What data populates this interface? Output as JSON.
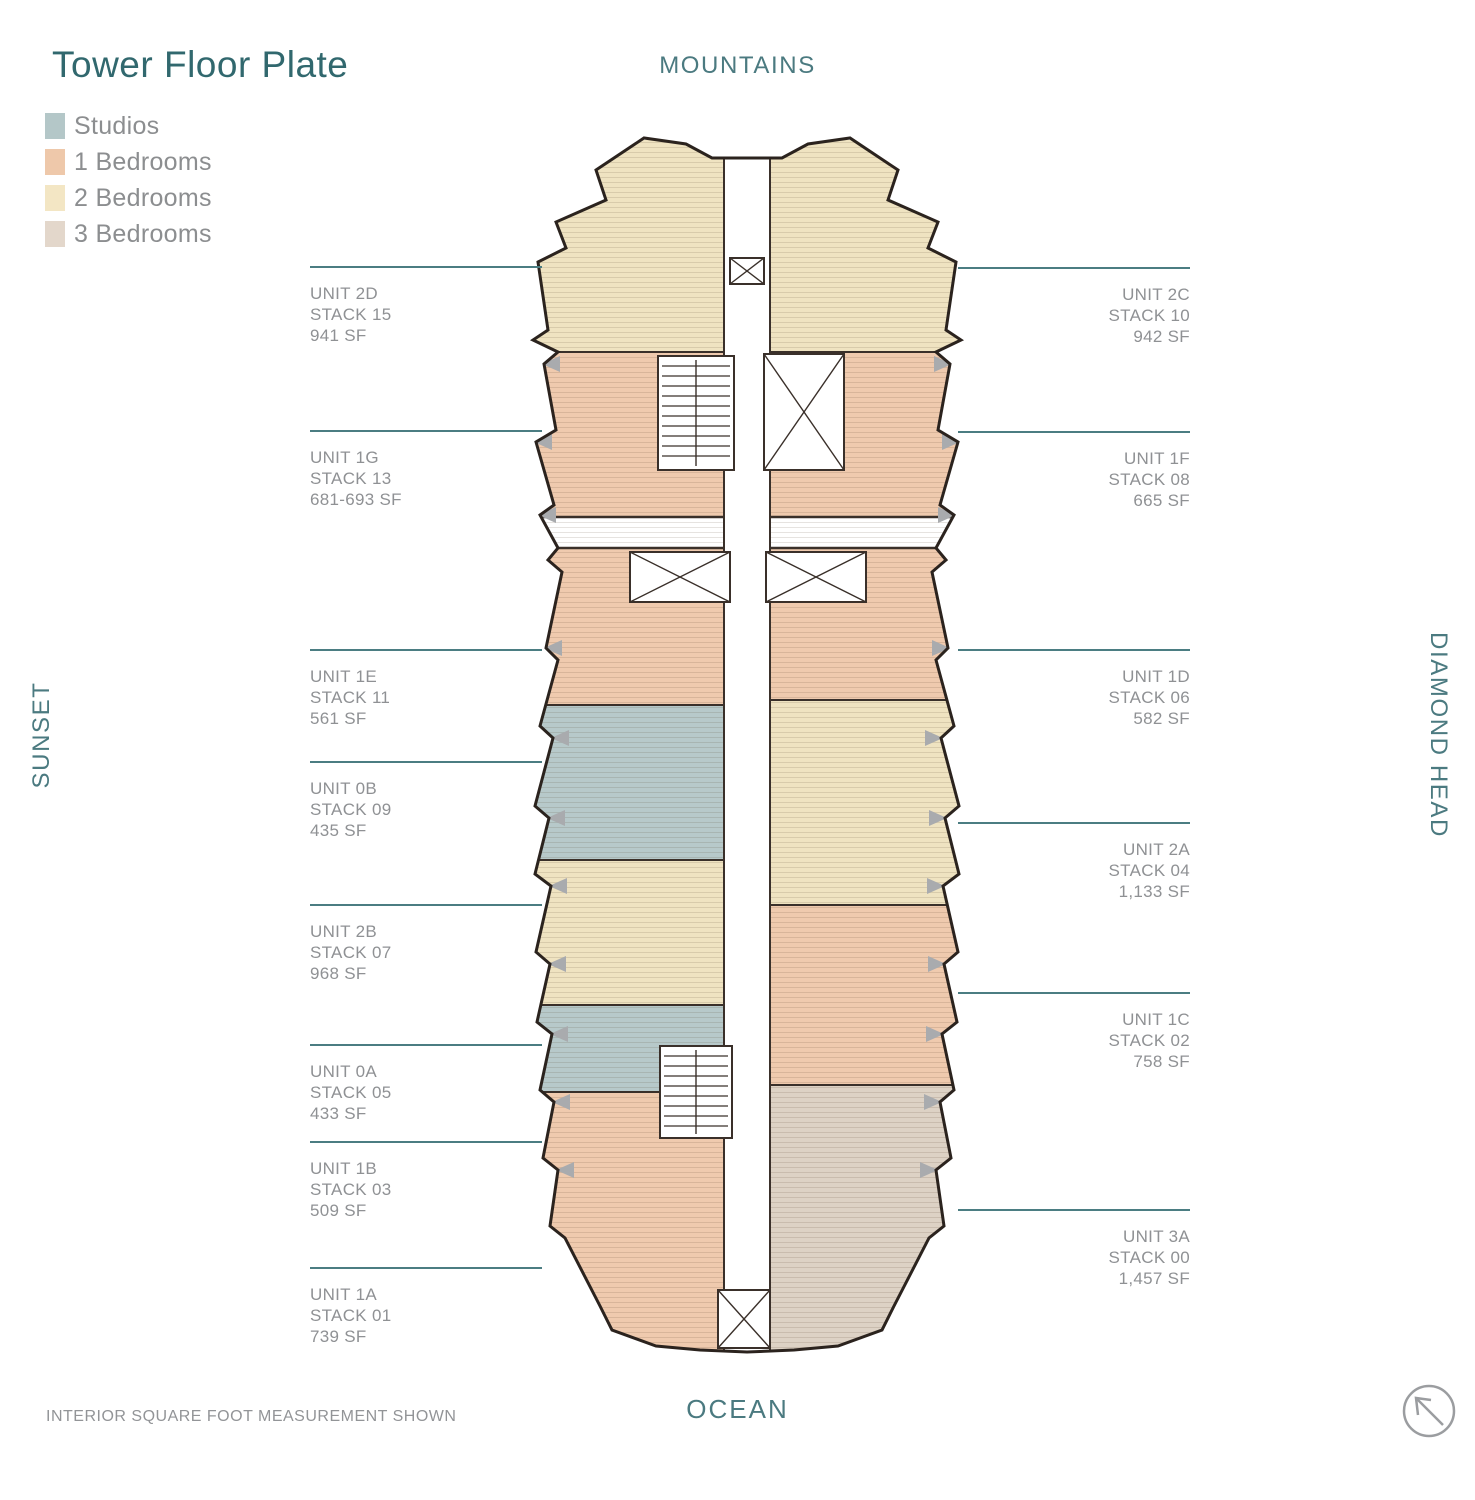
{
  "title": "Tower Floor Plate",
  "legend": {
    "items": [
      {
        "label": "Studios",
        "color": "#b4c7c8"
      },
      {
        "label": "1 Bedrooms",
        "color": "#eec8aa"
      },
      {
        "label": "2 Bedrooms",
        "color": "#f3e6c4"
      },
      {
        "label": "3 Bedrooms",
        "color": "#e3d7cb"
      }
    ]
  },
  "orientation": {
    "top": "MOUNTAINS",
    "bottom": "OCEAN",
    "left": "SUNSET",
    "right": "DIAMOND HEAD"
  },
  "units_left": [
    {
      "unit": "UNIT 2D",
      "stack": "STACK 15",
      "sf": "941 SF"
    },
    {
      "unit": "UNIT 1G",
      "stack": "STACK 13",
      "sf": "681-693 SF"
    },
    {
      "unit": "UNIT 1E",
      "stack": "STACK 11",
      "sf": "561 SF"
    },
    {
      "unit": "UNIT 0B",
      "stack": "STACK 09",
      "sf": "435 SF"
    },
    {
      "unit": "UNIT 2B",
      "stack": "STACK 07",
      "sf": "968 SF"
    },
    {
      "unit": "UNIT 0A",
      "stack": "STACK 05",
      "sf": "433 SF"
    },
    {
      "unit": "UNIT 1B",
      "stack": "STACK 03",
      "sf": "509 SF"
    },
    {
      "unit": "UNIT 1A",
      "stack": "STACK 01",
      "sf": "739 SF"
    }
  ],
  "units_right": [
    {
      "unit": "UNIT 2C",
      "stack": "STACK 10",
      "sf": "942 SF"
    },
    {
      "unit": "UNIT 1F",
      "stack": "STACK 08",
      "sf": "665 SF"
    },
    {
      "unit": "UNIT 1D",
      "stack": "STACK 06",
      "sf": "582 SF"
    },
    {
      "unit": "UNIT 2A",
      "stack": "STACK 04",
      "sf": "1,133 SF"
    },
    {
      "unit": "UNIT 1C",
      "stack": "STACK 02",
      "sf": "758 SF"
    },
    {
      "unit": "UNIT 3A",
      "stack": "STACK 00",
      "sf": "1,457 SF"
    }
  ],
  "footnote": "INTERIOR SQUARE FOOT MEASUREMENT SHOWN",
  "icons": {
    "compass": "north-arrow-icon"
  },
  "plan_colors": {
    "studio": "#b7c9ca",
    "one_bed": "#efcaae",
    "two_bed": "#efe3c1",
    "three_bed": "#ddd2c5",
    "outline": "#2b231e",
    "wall": "#3a302a",
    "core_gray": "#a9abae",
    "pointer_line": "#4b7d82"
  }
}
